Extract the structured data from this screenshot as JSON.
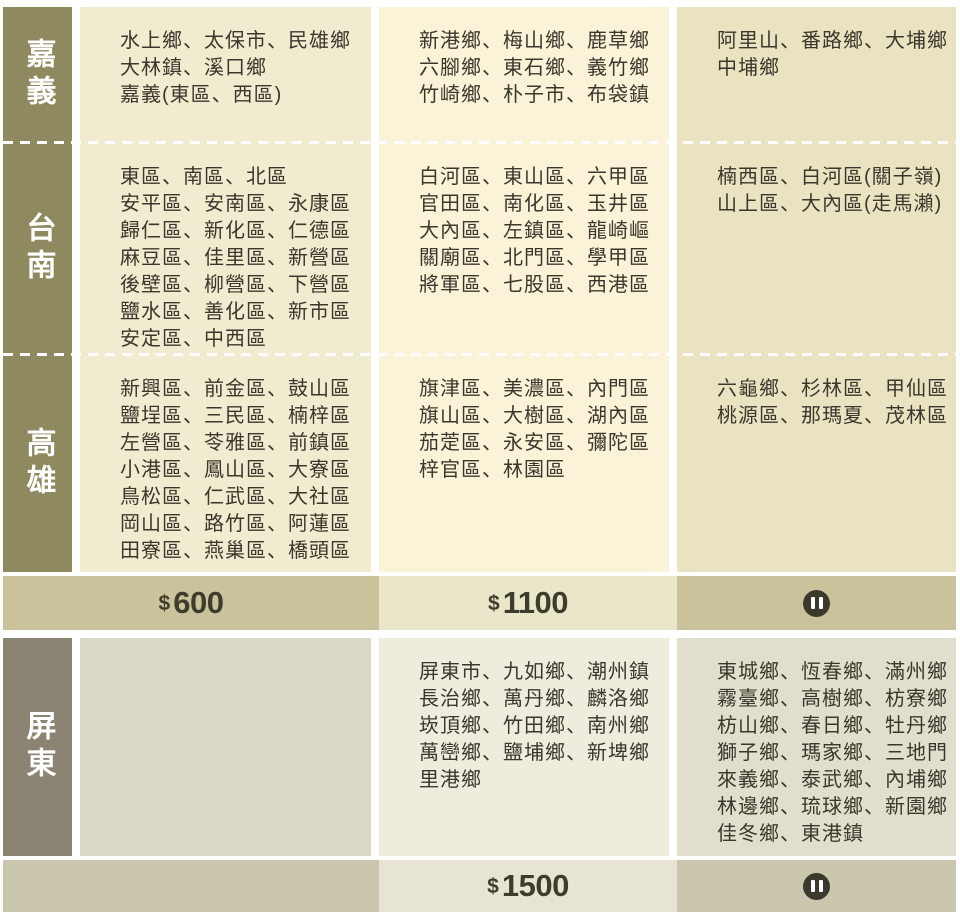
{
  "regions": [
    {
      "name": "嘉義",
      "cells": [
        {
          "lines": [
            "水上鄉、太保市、民雄鄉",
            "大林鎮、溪口鄉",
            "嘉義(東區、西區)"
          ]
        },
        {
          "lines": [
            "新港鄉、梅山鄉、鹿草鄉",
            "六腳鄉、東石鄉、義竹鄉",
            "竹崎鄉、朴子市、布袋鎮"
          ]
        },
        {
          "lines": [
            "阿里山、番路鄉、大埔鄉",
            "中埔鄉"
          ]
        }
      ]
    },
    {
      "name": "台南",
      "cells": [
        {
          "lines": [
            "東區、南區、北區",
            "安平區、安南區、永康區",
            "歸仁區、新化區、仁德區",
            "麻豆區、佳里區、新營區",
            "後壁區、柳營區、下營區",
            "鹽水區、善化區、新市區",
            "安定區、中西區"
          ]
        },
        {
          "lines": [
            "白河區、東山區、六甲區",
            "官田區、南化區、玉井區",
            "大內區、左鎮區、龍崎嶇",
            "關廟區、北門區、學甲區",
            "將軍區、七股區、西港區"
          ]
        },
        {
          "lines": [
            "楠西區、白河區(關子嶺)",
            "山上區、大內區(走馬瀨)"
          ]
        }
      ]
    },
    {
      "name": "高雄",
      "cells": [
        {
          "lines": [
            "新興區、前金區、鼓山區",
            "鹽埕區、三民區、楠梓區",
            "左營區、苓雅區、前鎮區",
            "小港區、鳳山區、大寮區",
            "鳥松區、仁武區、大社區",
            "岡山區、路竹區、阿蓮區",
            "田寮區、燕巢區、橋頭區"
          ]
        },
        {
          "lines": [
            "旗津區、美濃區、內門區",
            "旗山區、大樹區、湖內區",
            "茄萣區、永安區、彌陀區",
            "梓官區、林園區"
          ]
        },
        {
          "lines": [
            "六龜鄉、杉林區、甲仙區",
            "桃源區、那瑪夏、茂林區"
          ]
        }
      ]
    },
    {
      "name": "屏東",
      "cells": [
        {
          "lines": []
        },
        {
          "lines": [
            "屏東市、九如鄉、潮州鎮",
            "長治鄉、萬丹鄉、麟洛鄉",
            "崁頂鄉、竹田鄉、南州鄉",
            "萬巒鄉、鹽埔鄉、新埤鄉",
            "里港鄉"
          ]
        },
        {
          "lines": [
            "東城鄉、恆春鄉、滿州鄉",
            "霧臺鄉、高樹鄉、枋寮鄉",
            "枋山鄉、春日鄉、牡丹鄉",
            "獅子鄉、瑪家鄉、三地門",
            "來義鄉、泰武鄉、內埔鄉",
            "林邊鄉、琉球鄉、新園鄉",
            "佳冬鄉、東港鎮"
          ]
        }
      ]
    }
  ],
  "price_rows": [
    {
      "cells": [
        {
          "type": "price",
          "currency": "$",
          "amount": "600"
        },
        {
          "type": "price",
          "currency": "$",
          "amount": "1100"
        },
        {
          "type": "pause",
          "icon": "pause-icon"
        }
      ]
    },
    {
      "cells": [
        {
          "type": "empty"
        },
        {
          "type": "price",
          "currency": "$",
          "amount": "1500"
        },
        {
          "type": "pause",
          "icon": "pause-icon"
        }
      ]
    }
  ],
  "colors": {
    "label-olive": "#8e895e",
    "cream1": "#f1ebcf",
    "cream2": "#faf3d8",
    "cream3": "#eae3c2",
    "tan": "#c9c29b",
    "tan-light": "#e9e6c9",
    "gray-label": "#8b8473",
    "gray1": "#dbd8c6",
    "gray2": "#efecdd",
    "gray3": "#e1decd",
    "tan2": "#cbc7ae",
    "tan2-light": "#e7e4d3",
    "ink": "#3a382c",
    "price-ink": "#3e3c2d",
    "pause-bg": "#3b392b"
  }
}
